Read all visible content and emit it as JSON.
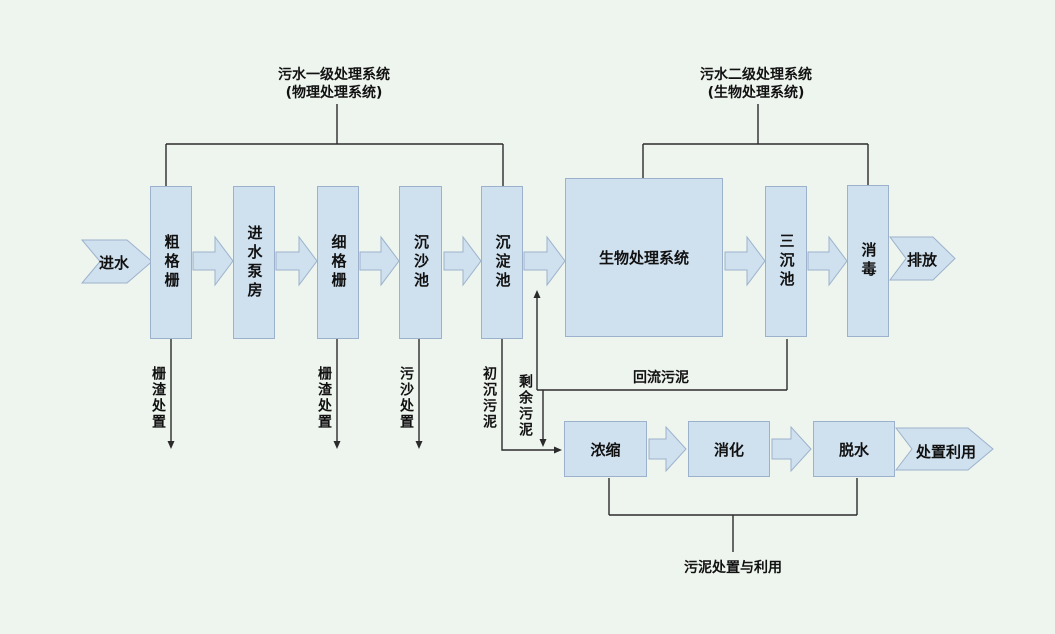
{
  "colors": {
    "background": "#eef4ee",
    "box_fill": "#cfe0ef",
    "box_border": "#9cb2cc",
    "line": "#2b2b2b",
    "text": "#111111"
  },
  "headers": {
    "primary": {
      "line1": "污水一级处理系统",
      "line2": "(物理处理系统)"
    },
    "secondary": {
      "line1": "污水二级处理系统",
      "line2": "(生物处理系统)"
    }
  },
  "flow": {
    "inflow": "进水",
    "stages": [
      "粗格栅",
      "进水泵房",
      "细格栅",
      "沉沙池",
      "沉淀池",
      "生物处理系统",
      "三沉池",
      "消毒"
    ],
    "outflow": "排放"
  },
  "byproducts": {
    "screenings1": "栅渣处置",
    "screenings2": "栅渣处置",
    "grit": "污沙处置",
    "primary_sludge": "初沉污泥",
    "excess_sludge": "剩余污泥",
    "return_sludge": "回流污泥"
  },
  "sludge_line": {
    "stages": [
      "浓缩",
      "消化",
      "脱水"
    ],
    "outflow": "处置利用",
    "caption": "污泥处置与利用"
  }
}
